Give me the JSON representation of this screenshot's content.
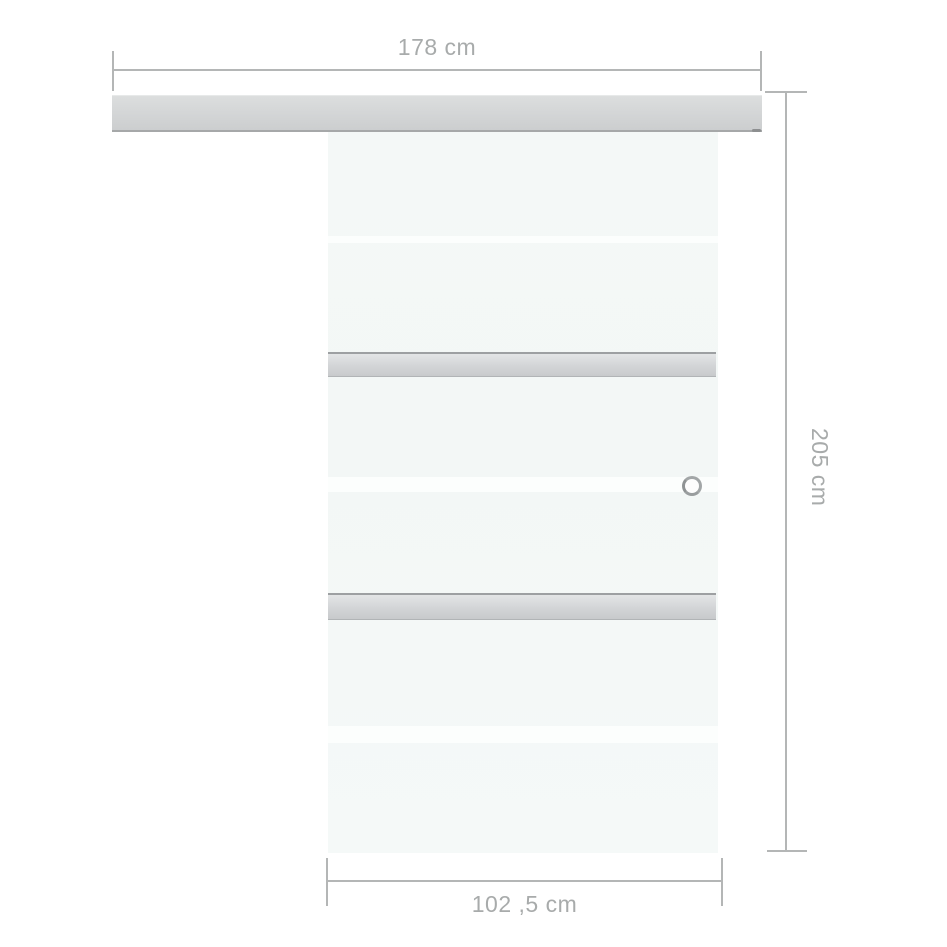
{
  "diagram": {
    "kind": "product-dimension-diagram",
    "subject": "sliding glass door with top track",
    "labels": {
      "track_width": "178 cm",
      "door_height": "205 cm",
      "door_width": "102 ,5 cm"
    },
    "colors": {
      "background": "#ffffff",
      "dimension_line": "#b4b6b6",
      "dimension_text": "#a8abab",
      "track_fill": "#d3d5d6",
      "track_edge": "#a6a8a9",
      "glass_fill": "#f4f8f7",
      "glass_stripe": "#fcfefd",
      "bar_fill": "#d4d6d8",
      "bar_edge": "#9da0a2",
      "handle_ring": "#a2a6a7"
    }
  }
}
